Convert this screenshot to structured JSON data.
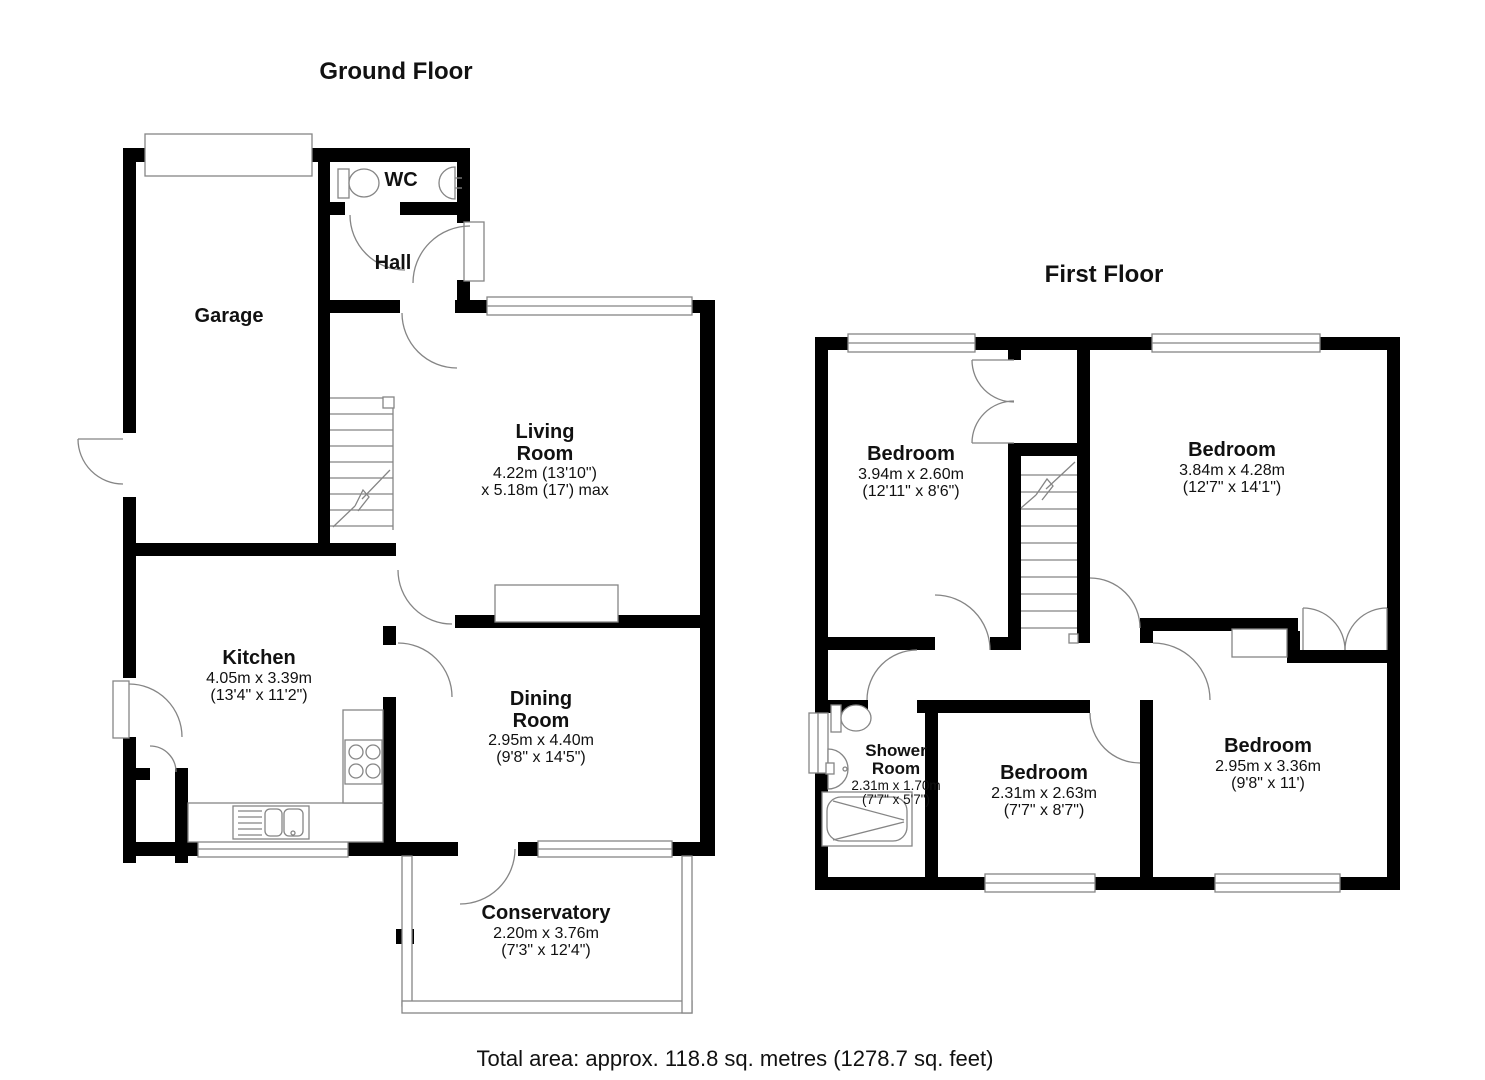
{
  "floors": {
    "ground": {
      "title": "Ground Floor",
      "rooms": {
        "garage": {
          "name": "Garage"
        },
        "wc": {
          "name": "WC"
        },
        "hall": {
          "name": "Hall"
        },
        "living": {
          "name1": "Living",
          "name2": "Room",
          "dim1": "4.22m (13'10\")",
          "dim2": "x 5.18m (17') max"
        },
        "kitchen": {
          "name": "Kitchen",
          "dim1": "4.05m x 3.39m",
          "dim2": "(13'4\" x 11'2\")"
        },
        "dining": {
          "name1": "Dining",
          "name2": "Room",
          "dim1": "2.95m x 4.40m",
          "dim2": "(9'8\" x 14'5\")"
        },
        "conservatory": {
          "name": "Conservatory",
          "dim1": "2.20m x 3.76m",
          "dim2": "(7'3\" x 12'4\")"
        }
      }
    },
    "first": {
      "title": "First Floor",
      "rooms": {
        "bedroom_tl": {
          "name": "Bedroom",
          "dim1": "3.94m x 2.60m",
          "dim2": "(12'11\" x 8'6\")"
        },
        "bedroom_tr": {
          "name": "Bedroom",
          "dim1": "3.84m x 4.28m",
          "dim2": "(12'7\" x 14'1\")"
        },
        "shower": {
          "name1": "Shower",
          "name2": "Room",
          "dim1": "2.31m x 1.70m",
          "dim2": "(7'7\" x 5'7\")"
        },
        "bedroom_bm": {
          "name": "Bedroom",
          "dim1": "2.31m x 2.63m",
          "dim2": "(7'7\" x 8'7\")"
        },
        "bedroom_br": {
          "name": "Bedroom",
          "dim1": "2.95m x 3.36m",
          "dim2": "(9'8\" x 11')"
        }
      }
    }
  },
  "footer": {
    "total_area": "Total area: approx. 118.8 sq. metres (1278.7 sq. feet)"
  },
  "colors": {
    "wall": "#000000",
    "line": "#858585",
    "background": "#ffffff"
  }
}
